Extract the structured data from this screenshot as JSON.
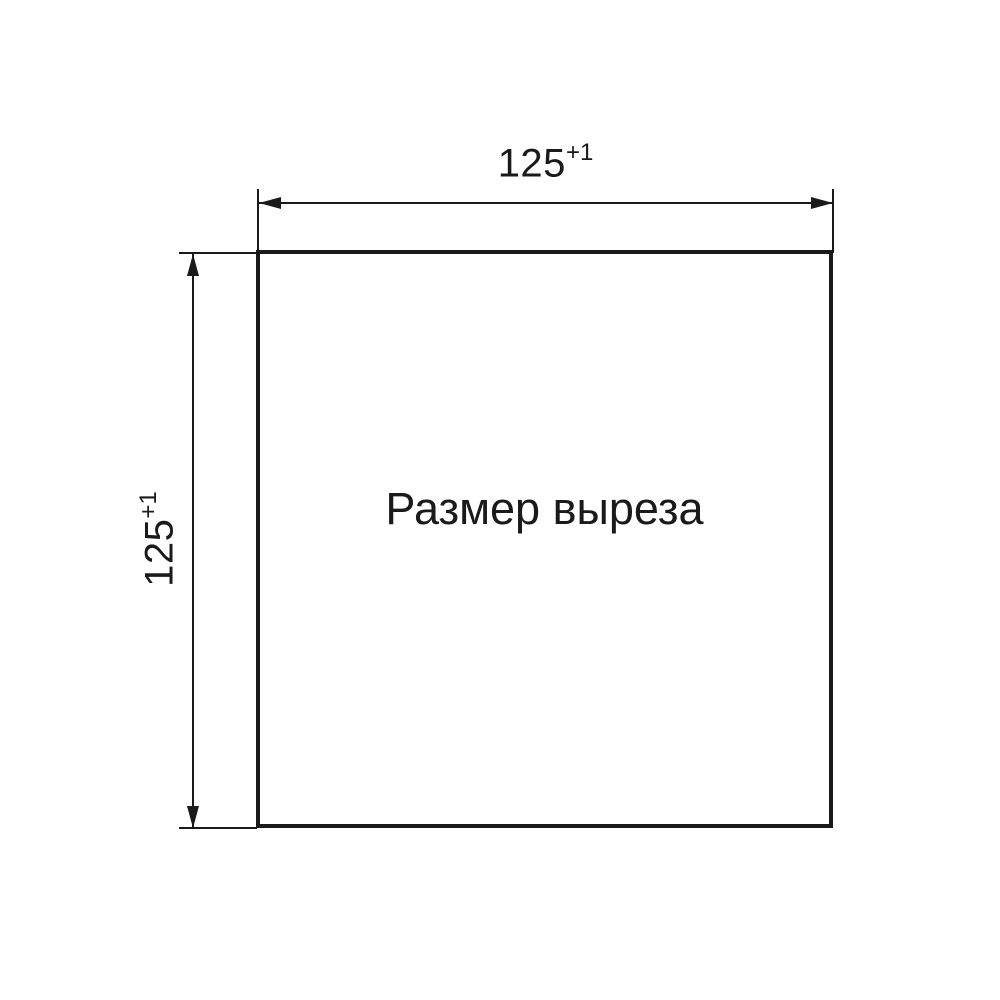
{
  "drawing": {
    "center_label": "Размер выреза",
    "width_dimension": {
      "value": "125",
      "tolerance": "+1"
    },
    "height_dimension": {
      "value": "125",
      "tolerance": "+1"
    },
    "colors": {
      "line": "#1a1a1a",
      "background": "#ffffff"
    }
  }
}
